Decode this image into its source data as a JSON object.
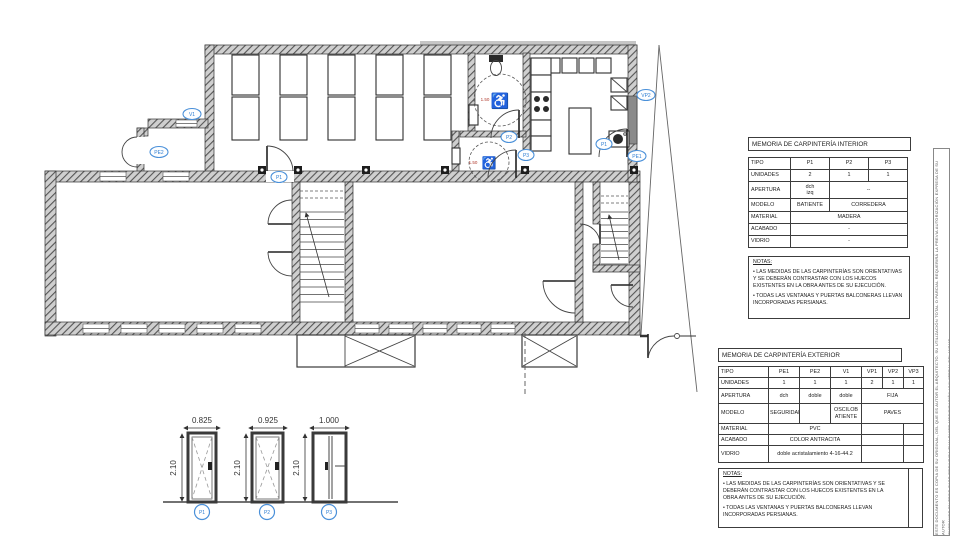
{
  "plan": {
    "wheelchair_icon": "♿",
    "wc1_radius": "1.50",
    "wc2_radius": "1.50",
    "labels": [
      {
        "text": "V1"
      },
      {
        "text": "PE2"
      },
      {
        "text": "P1"
      },
      {
        "text": "P2"
      },
      {
        "text": "P3"
      },
      {
        "text": "P1"
      },
      {
        "text": "PE1"
      },
      {
        "text": "VP2"
      }
    ]
  },
  "details": {
    "doors": [
      {
        "label": "P1",
        "width": "0.825",
        "height": "2.10"
      },
      {
        "label": "P2",
        "width": "0.925",
        "height": "2.10"
      },
      {
        "label": "P3",
        "width": "1.000",
        "height": "2.10"
      }
    ]
  },
  "tables": {
    "interior": {
      "title": "MEMORIA DE CARPINTERÍA INTERIOR",
      "rows": {
        "tipo": {
          "h": "TIPO",
          "p1": "P1",
          "p2": "P2",
          "p3": "P3"
        },
        "unidades": {
          "h": "UNIDADES",
          "p1": "2",
          "p2": "1",
          "p3": "1"
        },
        "apertura": {
          "h": "APERTURA",
          "p1": "dch\nizq",
          "rest": "--"
        },
        "modelo": {
          "h": "MODELO",
          "p1": "BATIENTE",
          "rest": "CORREDERA"
        },
        "material": {
          "h": "MATERIAL",
          "all": "MADERA"
        },
        "acabado": {
          "h": "ACABADO",
          "all": "-"
        },
        "vidrio": {
          "h": "VIDRIO",
          "all": "-"
        }
      },
      "notas_title": "NOTAS:",
      "nota1": "• LAS MEDIDAS DE LAS CARPINTERÍAS SON ORIENTATIVAS Y SE DEBERÁN CONTRASTAR CON LOS HUECOS EXISTENTES EN LA OBRA ANTES DE SU EJECUCIÓN.",
      "nota2": "• TODAS LAS VENTANAS Y PUERTAS BALCONERAS LLEVAN INCORPORADAS PERSIANAS."
    },
    "exterior": {
      "title": "MEMORIA DE CARPINTERÍA EXTERIOR",
      "rows": {
        "tipo": {
          "h": "TIPO",
          "pe1": "PE1",
          "pe2": "PE2",
          "v1": "V1",
          "vp1": "VP1",
          "vp2": "VP2",
          "vp3": "VP3"
        },
        "unidades": {
          "h": "UNIDADES",
          "pe1": "1",
          "pe2": "1",
          "v1": "1",
          "vp1": "2",
          "vp2": "1",
          "vp3": "1"
        },
        "apertura": {
          "h": "APERTURA",
          "pe1": "dch",
          "pe2": "doble",
          "v1": "doble",
          "vp": "FIJA"
        },
        "modelo": {
          "h": "MODELO",
          "pe1": "SEGURIDAD",
          "pe2": "",
          "v1": "OSCILOB ATIENTE",
          "vp": "PAVES"
        },
        "material": {
          "h": "MATERIAL",
          "main": "PVC",
          "vp12": "",
          "vp3": ""
        },
        "acabado": {
          "h": "ACABADO",
          "main": "COLOR ANTRACITA",
          "vp12": "",
          "vp3": ""
        },
        "vidrio": {
          "h": "VIDRIO",
          "main": "doble acristalamiento 4-16-44.2",
          "vp12": "",
          "vp3": ""
        }
      },
      "notas_title": "NOTAS:",
      "nota1": "• LAS MEDIDAS DE LAS CARPINTERÍAS SON ORIENTATIVAS Y SE DEBERÁN CONTRASTAR CON LOS HUECOS EXISTENTES EN LA OBRA ANTES DE SU EJECUCIÓN.",
      "nota2": "• TODAS LAS VENTANAS Y PUERTAS BALCONERAS LLEVAN INCORPORADAS PERSIANAS."
    }
  },
  "disclaimer": {
    "line1": "ESTE DOCUMENTO ES COPIA DE SU ORIGINAL, DEL QUE ES AUTOR EL ARQUITECTO. SU UTILIZACIÓN TOTAL O PARCIAL REQUERIRÁ LA PREVIA AUTORIZACIÓN EXPRESA DE SU AUTOR",
    "line2": "QUEDANDO EN TODO CASO PROHIBIDA CUALQUIER MODIFICACIÓN UNILATERAL DEL MISMO"
  },
  "colors": {
    "accent_blue": "#4a90d9",
    "line": "#3c3c3c",
    "radius_red": "#b03a2e"
  }
}
